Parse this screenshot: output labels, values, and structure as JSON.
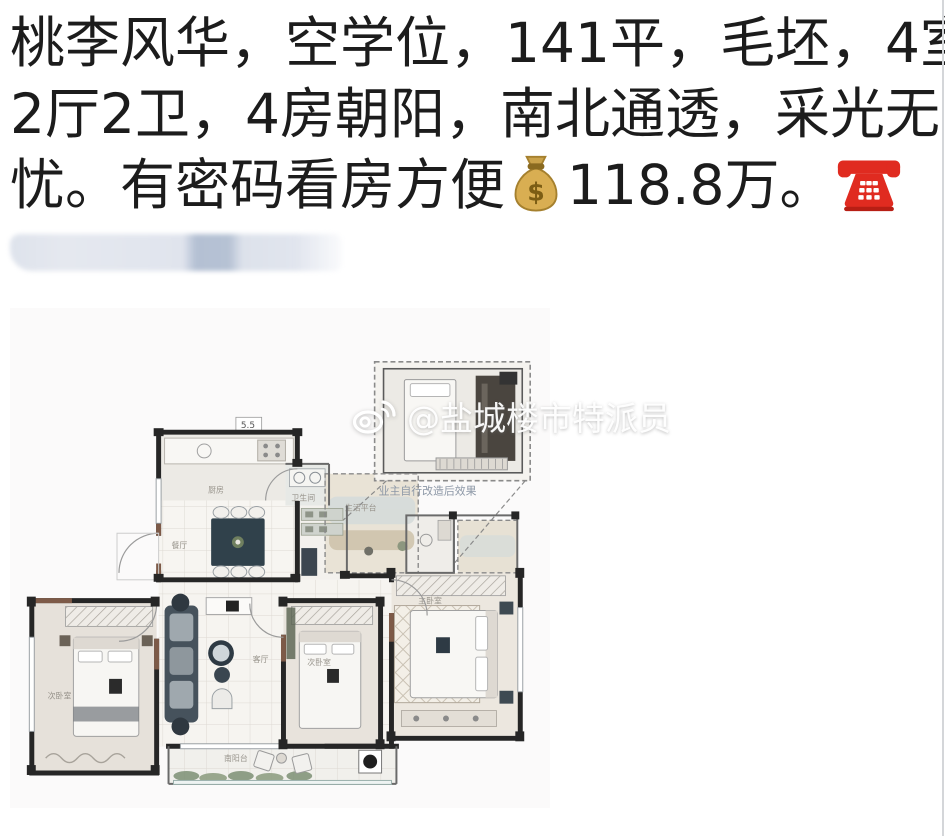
{
  "post": {
    "line1": "桃李风华，空学位，141平，毛坯，4室",
    "line2": "2厅2卫，4房朝阳，南北通透，采光无",
    "line3_prefix": "忧。有密码看房方便",
    "line3_price": "118.8万。",
    "money_emoji": "💰",
    "phone_emoji": "☎️",
    "text_color": "#1c1c1c"
  },
  "redaction": {
    "base_color": "#dfe3ec",
    "dark_patch_color": "#b5c1d3"
  },
  "floorplan": {
    "watermark_handle": "@盐城楼市特派员",
    "watermark_logo": "weibo-eye-logo",
    "inset_caption": "业主自行改造后效果",
    "dim_label": "5.5",
    "labels": {
      "kitchen": "厨房",
      "dining": "餐厅",
      "bath": "卫生间",
      "platform": "生活平台",
      "living": "客厅",
      "bedroom_left": "次卧室",
      "bedroom_mid": "次卧室",
      "bedroom_right": "主卧室",
      "balcony": "南阳台"
    },
    "colors": {
      "wall": "#262626",
      "accent_brown": "#7d5a48",
      "furniture_dark": "#3d4a54",
      "floor_light": "#f6f4f0"
    }
  }
}
